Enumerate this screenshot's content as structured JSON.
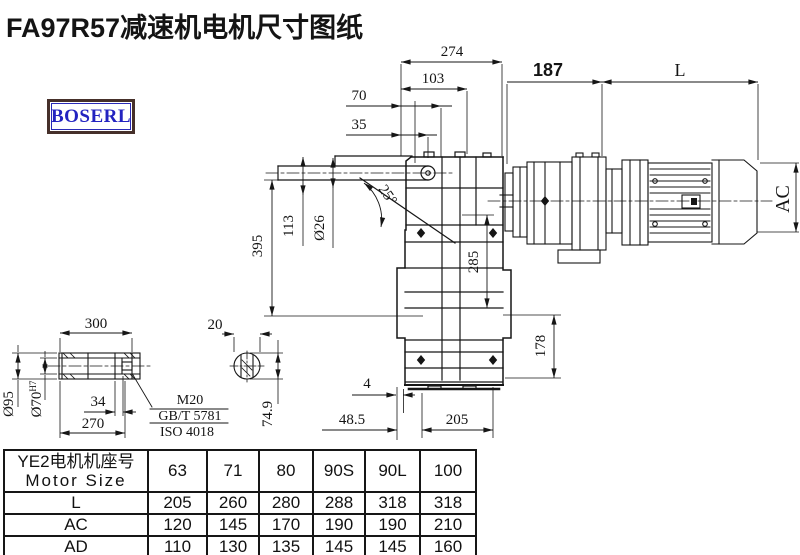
{
  "title": "FA97R57减速机电机尺寸图纸",
  "logo": {
    "text": "BOSERL"
  },
  "drawing": {
    "dims": {
      "w274": "274",
      "w103": "103",
      "w70": "70",
      "w35": "35",
      "w187": "187",
      "L": "L",
      "angle": "25°",
      "dia26": "Ø26",
      "h113": "113",
      "h395": "395",
      "h285": "285",
      "h178": "178",
      "AC": "AC",
      "s4": "4",
      "s48_5": "48.5",
      "s205": "205",
      "s74_9": "74.9",
      "s300": "300",
      "s20": "20",
      "dia95": "Ø95",
      "dia70": "Ø70",
      "dia70_sup": "H7",
      "s34": "34",
      "s270": "270"
    },
    "notes": {
      "thread": "M20",
      "standard1": "GB/T 5781",
      "standard2": "ISO 4018"
    }
  },
  "table": {
    "header_cn": "YE2电机机座号",
    "header_en": "Motor Size",
    "columns": [
      "63",
      "71",
      "80",
      "90S",
      "90L",
      "100"
    ],
    "rows": [
      {
        "label": "L",
        "values": [
          "205",
          "260",
          "280",
          "288",
          "318",
          "318"
        ]
      },
      {
        "label": "AC",
        "values": [
          "120",
          "145",
          "170",
          "190",
          "190",
          "210"
        ]
      },
      {
        "label": "AD",
        "values": [
          "110",
          "130",
          "135",
          "145",
          "145",
          "160"
        ]
      }
    ]
  }
}
